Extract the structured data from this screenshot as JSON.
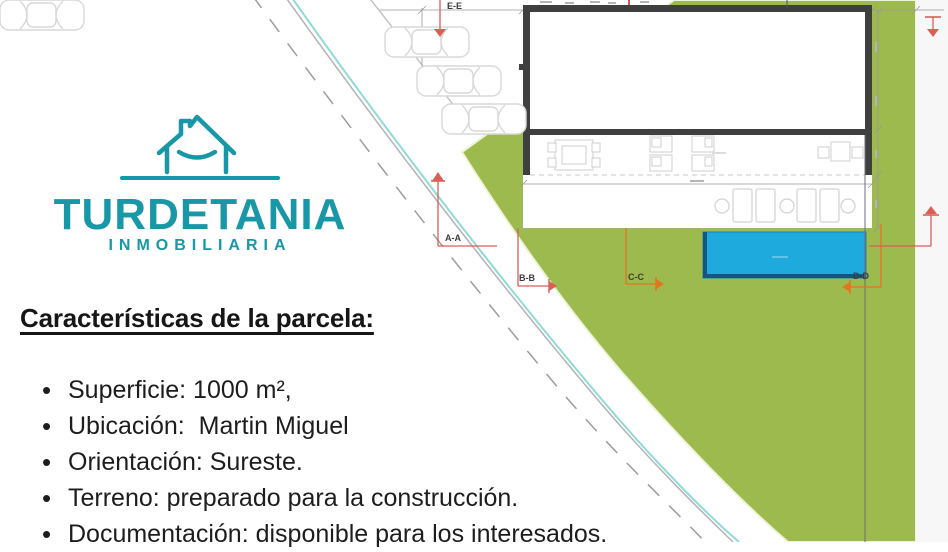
{
  "logo": {
    "brand": "TURDETANIA",
    "tagline": "INMOBILIARIA",
    "icon": "house-with-smile",
    "color": "#1898a6"
  },
  "content": {
    "heading": "Características de la parcela:",
    "bullets": [
      "Superficie: 1000 m²,",
      "Ubicación:  Martin Miguel",
      "Orientación: Sureste.",
      "Terreno: preparado para la construcción.",
      "Documentación: disponible para los interesados."
    ]
  },
  "plan": {
    "type": "architectural-site-plan",
    "labels": {
      "ee": "E-E",
      "aa": "A-A",
      "bb": "B-B",
      "cc": "C-C",
      "dd": "D-D"
    },
    "colors": {
      "parcel_green": "#9cba4d",
      "pool_blue": "#1faade",
      "building_wall": "#3f3f3f",
      "road_cyan": "#8edbd8",
      "marker_red": "#d95f57",
      "marker_orange": "#e0761f"
    }
  }
}
